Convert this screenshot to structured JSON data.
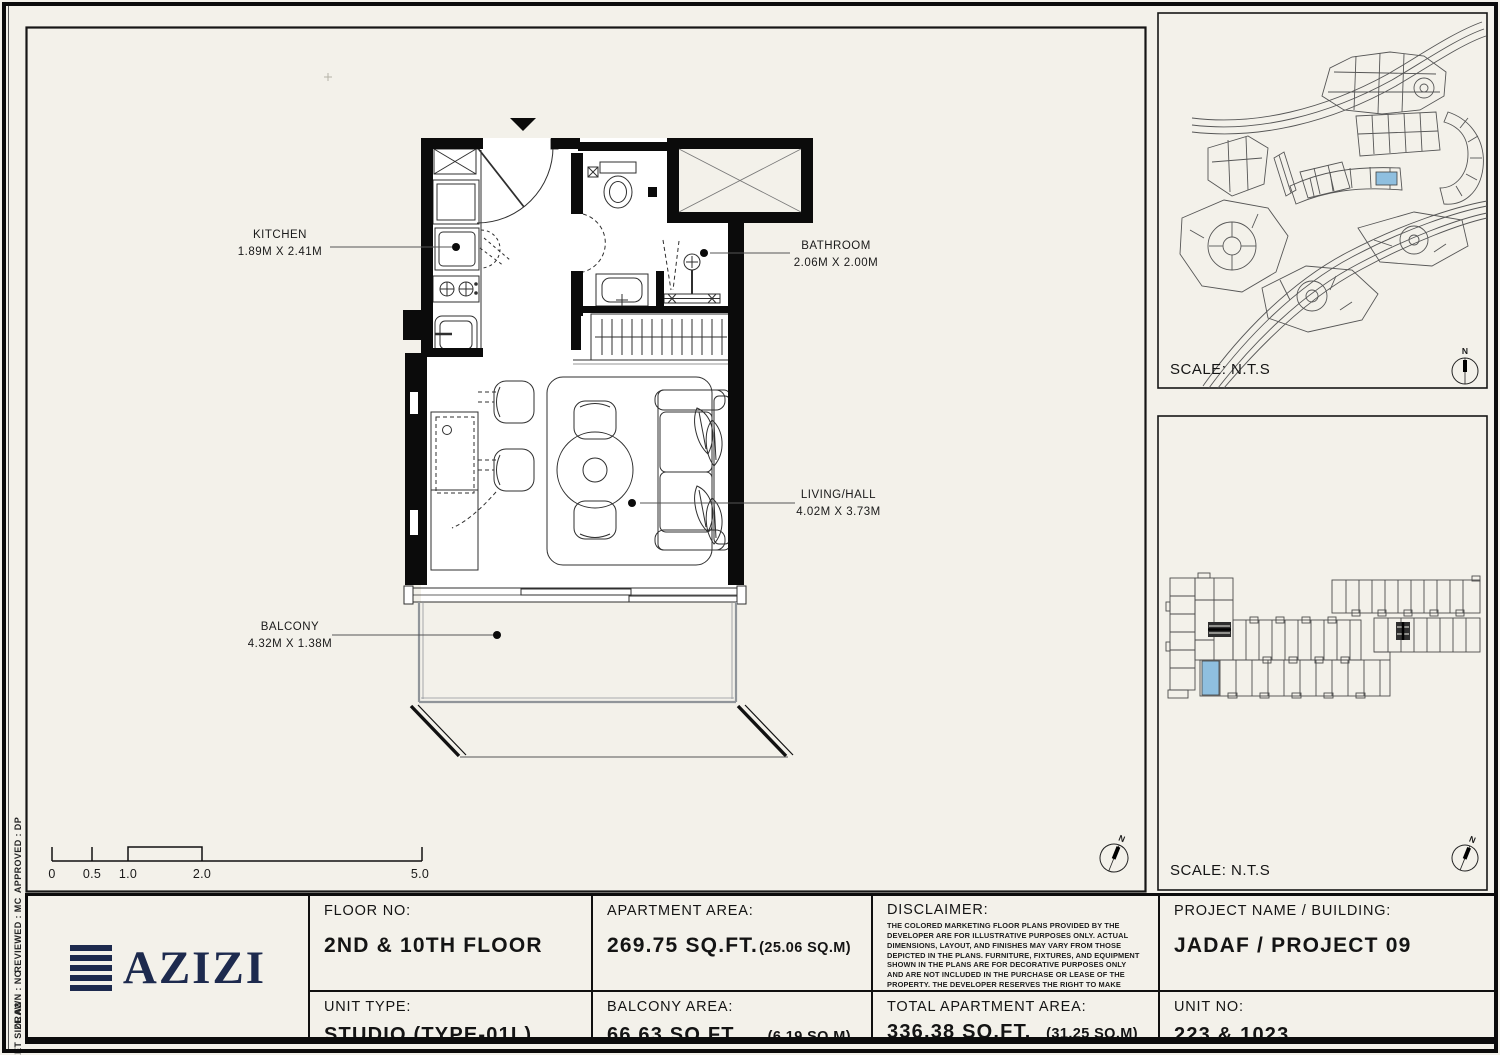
{
  "colors": {
    "paper": "#f3f1ea",
    "ink": "#141414",
    "wall": "#0b0b0b",
    "navy": "#1d2a4e",
    "highlight": "#8fbfdf"
  },
  "sheet_notes": {
    "approved": "APPROVED :  DP",
    "reviewed": "REVIEWED :  MC",
    "drawn": "DRAWN :  NC",
    "sheet_size": "SHEET SIZE A3"
  },
  "plan": {
    "north": "N",
    "rooms": [
      {
        "name": "KITCHEN",
        "dims": "1.89M X 2.41M"
      },
      {
        "name": "BATHROOM",
        "dims": "2.06M X 2.00M"
      },
      {
        "name": "LIVING/HALL",
        "dims": "4.02M X 3.73M"
      },
      {
        "name": "BALCONY",
        "dims": "4.32M X 1.38M"
      }
    ],
    "scale_bar": {
      "ticks": [
        "0",
        "0.5",
        "1.0",
        "2.0",
        "5.0"
      ]
    }
  },
  "side_maps": {
    "site": {
      "scale_label": "SCALE: N.T.S"
    },
    "building": {
      "scale_label": "SCALE: N.T.S"
    }
  },
  "title_block": {
    "logo_text": "AZIZI",
    "floor": {
      "label": "FLOOR NO:",
      "value": "2ND & 10TH FLOOR"
    },
    "unit_type": {
      "label": "UNIT TYPE:",
      "value": "STUDIO (TYPE-01L)"
    },
    "apartment_area": {
      "label": "APARTMENT AREA:",
      "value": "269.75 SQ.FT.",
      "metric": "(25.06 SQ.M)"
    },
    "balcony_area": {
      "label": "BALCONY AREA:",
      "value": "66.63 SQ.FT.",
      "metric": "(6.19 SQ.M)"
    },
    "disclaimer": {
      "label": "DISCLAIMER:",
      "text": "THE COLORED MARKETING FLOOR PLANS PROVIDED BY THE DEVELOPER ARE FOR ILLUSTRATIVE PURPOSES ONLY. ACTUAL DIMENSIONS, LAYOUT, AND FINISHES MAY VARY FROM THOSE DEPICTED IN THE PLANS. FURNITURE, FIXTURES, AND EQUIPMENT SHOWN IN THE PLANS ARE FOR DECORATIVE PURPOSES ONLY AND ARE NOT INCLUDED IN THE PURCHASE OR LEASE OF THE PROPERTY. THE DEVELOPER RESERVES THE RIGHT TO MAKE MODIFICATIONS, REVISIONS, AND CHANGES TO THE FLOOR PLANS, SPECIFICATIONS, AND FEATURES WITHOUT PRIOR NOTICE."
    },
    "total_area": {
      "label": "TOTAL APARTMENT AREA:",
      "value": "336.38 SQ.FT.",
      "metric": "(31.25 SQ.M)"
    },
    "project": {
      "label": "PROJECT NAME / BUILDING:",
      "value": "JADAF / PROJECT 09"
    },
    "unit_no": {
      "label": "UNIT NO:",
      "value": "223 & 1023"
    }
  }
}
